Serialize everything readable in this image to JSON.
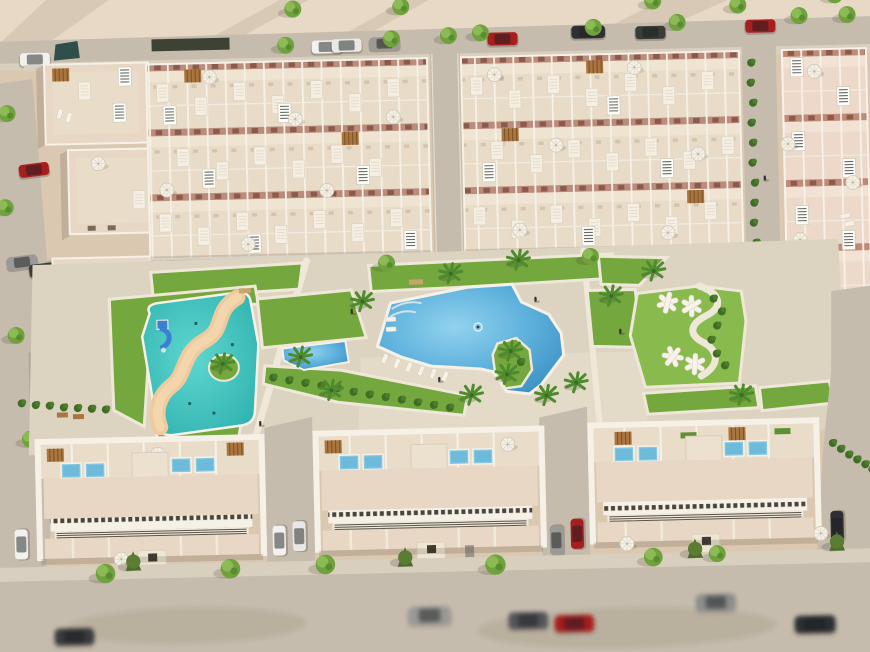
{
  "scene": {
    "type": "aerial-architectural-render",
    "description": "Bird's-eye 3D render of a beige Mediterranean residential development: three upper townhouse blocks with rooftop terraces, solar skylights and umbrellas, a central landscaped park with a large irregular blue pool with green island, a turquoise kids splash pool with sand lazy-river and blue slide, a small wedge lap pool, lawns with palms and white playground frames, and three long bottom apartment buildings with rooftop plunge pools, fronted by tree-lined streets with parked cars."
  },
  "colors": {
    "sand": "#dac8b1",
    "sand_light": "#e7d9c5",
    "road": "#c6bcae",
    "road_dark": "#b8aea1",
    "sidewalk": "#d9cfbe",
    "deck": "#ddd3c1",
    "deck_light": "#e4dac8",
    "path_white": "#efe8d9",
    "wall_cream": "#e7d7c4",
    "wall_pink": "#e7cec0",
    "terrace": "#e9ddc9",
    "roof_light": "#f0e7d7",
    "parapet_white": "#f6f1e7",
    "facade_band": "#bd8d7e",
    "lawn": "#74a73d",
    "lawn_light": "#89ba4e",
    "hedge": "#3f6d26",
    "tree_green": "#6fa23c",
    "tree_dark": "#49762c",
    "palm_green": "#4e8a2e",
    "pool_blue": "#55a9d6",
    "pool_light": "#8fd0ec",
    "pool_deep": "#3f93c6",
    "kids_pool": "#49c7c3",
    "kids_pool_light": "#5fd6d0",
    "river_sand": "#eeca9d",
    "slide_blue": "#3b7ed2",
    "pergola_brown": "#a9763f",
    "car_red": "#a81e1e",
    "car_white": "#f2f1ed",
    "car_grey": "#9b9a96",
    "car_black": "#2f2f33",
    "shadow_ink": "#3c3024"
  },
  "inventory": {
    "upper_townhouse_blocks": 3,
    "left_end_houses": 4,
    "bottom_apartment_buildings": 3,
    "rooftop_plunge_pools": 12,
    "main_pool": 1,
    "kids_splash_pool": 1,
    "lap_pool": 1,
    "playground_frames": 4,
    "parked_cars": 20,
    "street_trees": 22,
    "palm_trees": 14,
    "sun_umbrellas": 18,
    "solar_skylights": 16
  }
}
